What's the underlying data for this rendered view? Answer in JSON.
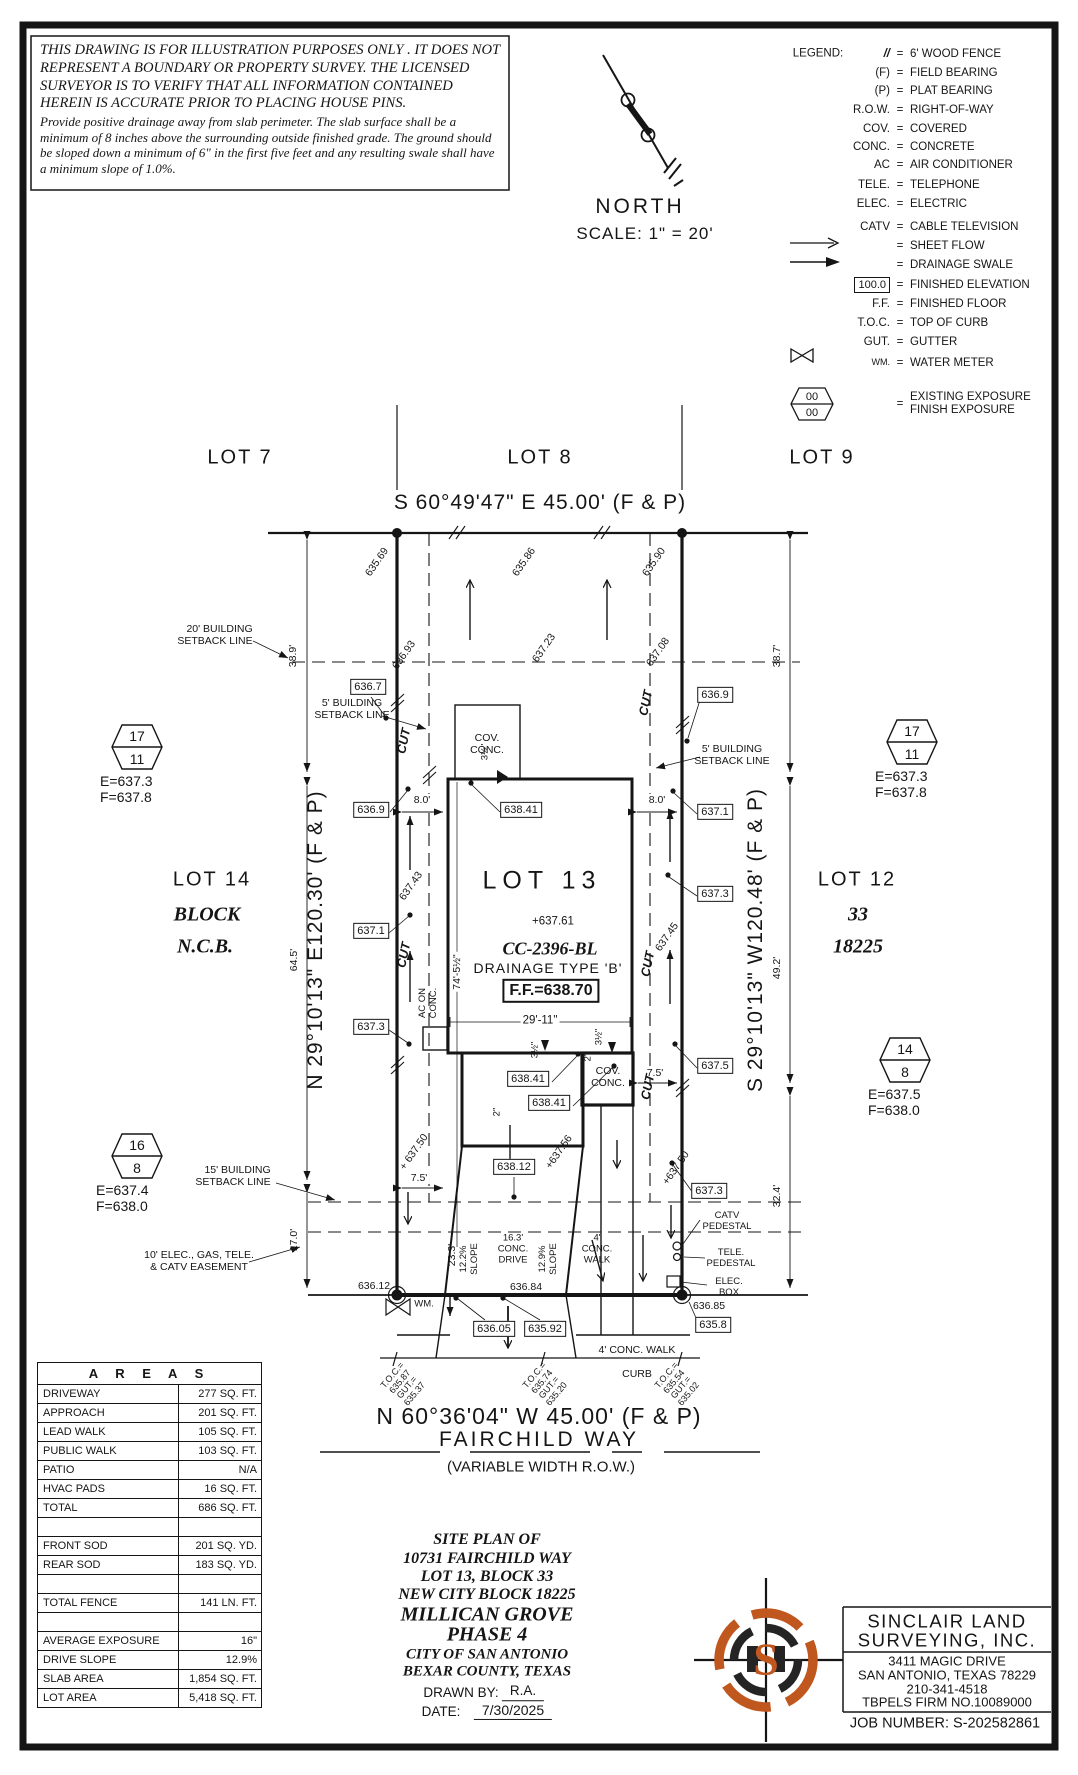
{
  "colors": {
    "ink": "#151515",
    "accent": "#c0571f"
  },
  "disclaimer": {
    "main": "THIS DRAWING IS FOR ILLUSTRATION PURPOSES ONLY . IT DOES NOT REPRESENT A BOUNDARY OR PROPERTY SURVEY. THE LICENSED SURVEYOR IS TO VERIFY THAT ALL INFORMATION CONTAINED HEREIN IS ACCURATE PRIOR TO PLACING HOUSE PINS.",
    "note": "Provide positive drainage away from slab perimeter. The slab surface shall be a minimum of 8 inches above the surrounding outside finished grade. The ground should be sloped down a minimum of 6\" in the first five feet and any resulting swale shall have a minimum slope of 1.0%."
  },
  "north": {
    "label": "NORTH",
    "scale": "SCALE: 1\" = 20'"
  },
  "legend": {
    "title": "LEGEND:",
    "eq": "=",
    "items": [
      {
        "sym": "//",
        "text": "6' WOOD FENCE"
      },
      {
        "sym": "(F)",
        "text": "FIELD BEARING"
      },
      {
        "sym": "(P)",
        "text": "PLAT BEARING"
      },
      {
        "sym": "R.O.W.",
        "text": "RIGHT-OF-WAY"
      },
      {
        "sym": "COV.",
        "text": "COVERED"
      },
      {
        "sym": "CONC.",
        "text": "CONCRETE"
      },
      {
        "sym": "AC",
        "text": "AIR CONDITIONER"
      },
      {
        "sym": "TELE.",
        "text": "TELEPHONE"
      },
      {
        "sym": "ELEC.",
        "text": "ELECTRIC"
      },
      {
        "sym": "CATV",
        "text": "CABLE TELEVISION"
      },
      {
        "sym": "",
        "text": "SHEET FLOW"
      },
      {
        "sym": "",
        "text": "DRAINAGE SWALE"
      },
      {
        "sym": "100.0",
        "text": "FINISHED ELEVATION"
      },
      {
        "sym": "F.F.",
        "text": "FINISHED FLOOR"
      },
      {
        "sym": "T.O.C.",
        "text": "TOP OF CURB"
      },
      {
        "sym": "GUT.",
        "text": "GUTTER"
      },
      {
        "sym": "WM.",
        "text": "WATER METER"
      },
      {
        "sym": "",
        "top": "00",
        "bottom": "00",
        "text": "EXISTING EXPOSURE",
        "text2": "FINISH EXPOSURE"
      }
    ]
  },
  "adjacent_lots": {
    "lot7": "LOT 7",
    "lot8": "LOT 8",
    "lot9": "LOT 9"
  },
  "bearings": {
    "rear": "S 60°49'47\" E 45.00' (F & P)",
    "left": "N 29°10'13\" E120.30' (F & P)",
    "right": "S 29°10'13\" W120.48' (F & P)",
    "front": "N 60°36'04\" W 45.00' (F & P)"
  },
  "street": {
    "name": "FAIRCHILD WAY",
    "row": "(VARIABLE WIDTH R.O.W.)"
  },
  "west": {
    "lot": "LOT 14",
    "block": "BLOCK",
    "ncb": "N.C.B."
  },
  "east": {
    "lot": "LOT 12",
    "block": "33",
    "ncb": "18225"
  },
  "lot13": {
    "label": "LOT 13",
    "spot": "+637.61",
    "cc": "CC-2396-BL",
    "drainage": "DRAINAGE TYPE 'B'",
    "ff": "F.F.=638.70"
  },
  "exposure_markers": [
    {
      "top": "17",
      "bottom": "11",
      "e": "E=637.3",
      "f": "F=637.8"
    },
    {
      "top": "17",
      "bottom": "11",
      "e": "E=637.3",
      "f": "F=637.8"
    },
    {
      "top": "14",
      "bottom": "8",
      "e": "E=637.5",
      "f": "F=638.0"
    },
    {
      "top": "16",
      "bottom": "8",
      "e": "E=637.4",
      "f": "F=638.0"
    }
  ],
  "elev_boxes": [
    "636.7",
    "636.9",
    "637.1",
    "637.3",
    "636.9",
    "637.1",
    "637.3",
    "637.5",
    "637.3",
    "635.8",
    "638.41",
    "638.41",
    "638.41",
    "638.12",
    "636.05",
    "635.92"
  ],
  "spots": [
    "635.69",
    "635.86",
    "635.90",
    "636.93",
    "637.23",
    "637.08",
    "637.43",
    "637.45",
    "+ 637.50",
    "+637.50",
    "+637.56",
    "636.12",
    "636.84",
    "636.85"
  ],
  "dims": {
    "d38_9": "38.9'",
    "d38_7": "38.7'",
    "d8_0": "8.0'",
    "d64_5": "64.5'",
    "d49_2": "49.2'",
    "d32_4": "32.4'",
    "d17_0": "17.0'",
    "d29_11": "29'-11\"",
    "d74_5": "74'-5½\"",
    "d7_5": "7.5'",
    "d23_3": "23.3'"
  },
  "slopes": {
    "left": "12.2%",
    "right": "12.9%",
    "word": "SLOPE"
  },
  "drive_label": {
    "l1": "16.3'",
    "l2": "CONC.",
    "l3": "DRIVE"
  },
  "walk_label": {
    "l1": "4'",
    "l2": "CONC.",
    "l3": "WALK"
  },
  "walk4": "4' CONC. WALK",
  "curb_word": "CURB",
  "setback_labels": [
    {
      "l1": "20' BUILDING",
      "l2": "SETBACK LINE"
    },
    {
      "l1": "5' BUILDING",
      "l2": "SETBACK LINE"
    },
    {
      "l1": "5' BUILDING",
      "l2": "SETBACK LINE"
    },
    {
      "l1": "15' BUILDING",
      "l2": "SETBACK LINE"
    },
    {
      "l1": "10' ELEC., GAS, TELE.",
      "l2": "& CATV EASEMENT"
    }
  ],
  "misc": {
    "cov": "COV.",
    "conc": "CONC.",
    "ac_on": "AC ON",
    "cut": "CUT",
    "wm": "WM.",
    "catv": "CATV",
    "pedestal": "PEDESTAL",
    "tele": "TELE.",
    "elec": "ELEC.",
    "box": "BOX",
    "s35": "3½\"",
    "s2": "2\""
  },
  "curb_pts": [
    {
      "l1": "T.O.C.=",
      "l2": "635.87",
      "l3": "GUT.=",
      "l4": "635.37"
    },
    {
      "l1": "T.O.C.=",
      "l2": "635.74",
      "l3": "GUT.=",
      "l4": "635.20"
    },
    {
      "l1": "T.O.C.=",
      "l2": "635.54",
      "l3": "GUT.=",
      "l4": "635.02"
    }
  ],
  "areas_table": {
    "title": "A R E A S",
    "rows": [
      {
        "label": "DRIVEWAY",
        "value": "277 SQ. FT."
      },
      {
        "label": "APPROACH",
        "value": "201 SQ. FT."
      },
      {
        "label": "LEAD WALK",
        "value": "105 SQ. FT."
      },
      {
        "label": "PUBLIC WALK",
        "value": "103 SQ. FT."
      },
      {
        "label": "PATIO",
        "value": "N/A"
      },
      {
        "label": "HVAC PADS",
        "value": "16 SQ. FT."
      },
      {
        "label": "TOTAL",
        "value": "686 SQ. FT."
      },
      {
        "label": "",
        "value": ""
      },
      {
        "label": "FRONT SOD",
        "value": "201 SQ. YD."
      },
      {
        "label": "REAR SOD",
        "value": "183 SQ. YD."
      },
      {
        "label": "",
        "value": ""
      },
      {
        "label": "TOTAL FENCE",
        "value": "141 LN. FT."
      },
      {
        "label": "",
        "value": ""
      },
      {
        "label": "AVERAGE EXPOSURE",
        "value": "16\""
      },
      {
        "label": "DRIVE SLOPE",
        "value": "12.9%"
      },
      {
        "label": "SLAB AREA",
        "value": "1,854 SQ. FT."
      },
      {
        "label": "LOT AREA",
        "value": "5,418 SQ. FT."
      }
    ]
  },
  "title_block": {
    "l1": "SITE PLAN OF",
    "l2": "10731 FAIRCHILD WAY",
    "l3": "LOT 13, BLOCK 33",
    "l4": "NEW CITY BLOCK 18225",
    "l5": "MILLICAN GROVE",
    "l6": "PHASE 4",
    "l7": "CITY OF SAN ANTONIO",
    "l8": "BEXAR COUNTY, TEXAS",
    "drawn_by_label": "DRAWN BY:",
    "drawn_by": "R.A.",
    "date_label": "DATE:",
    "date": "7/30/2025"
  },
  "firm": {
    "name1": "SINCLAIR LAND",
    "name2": "SURVEYING, INC.",
    "addr1": "3411 MAGIC DRIVE",
    "addr2": "SAN ANTONIO, TEXAS 78229",
    "addr3": "210-341-4518",
    "addr4": "TBPELS FIRM NO.10089000",
    "job": "JOB NUMBER: S-202582861",
    "logo_letter": "S"
  }
}
